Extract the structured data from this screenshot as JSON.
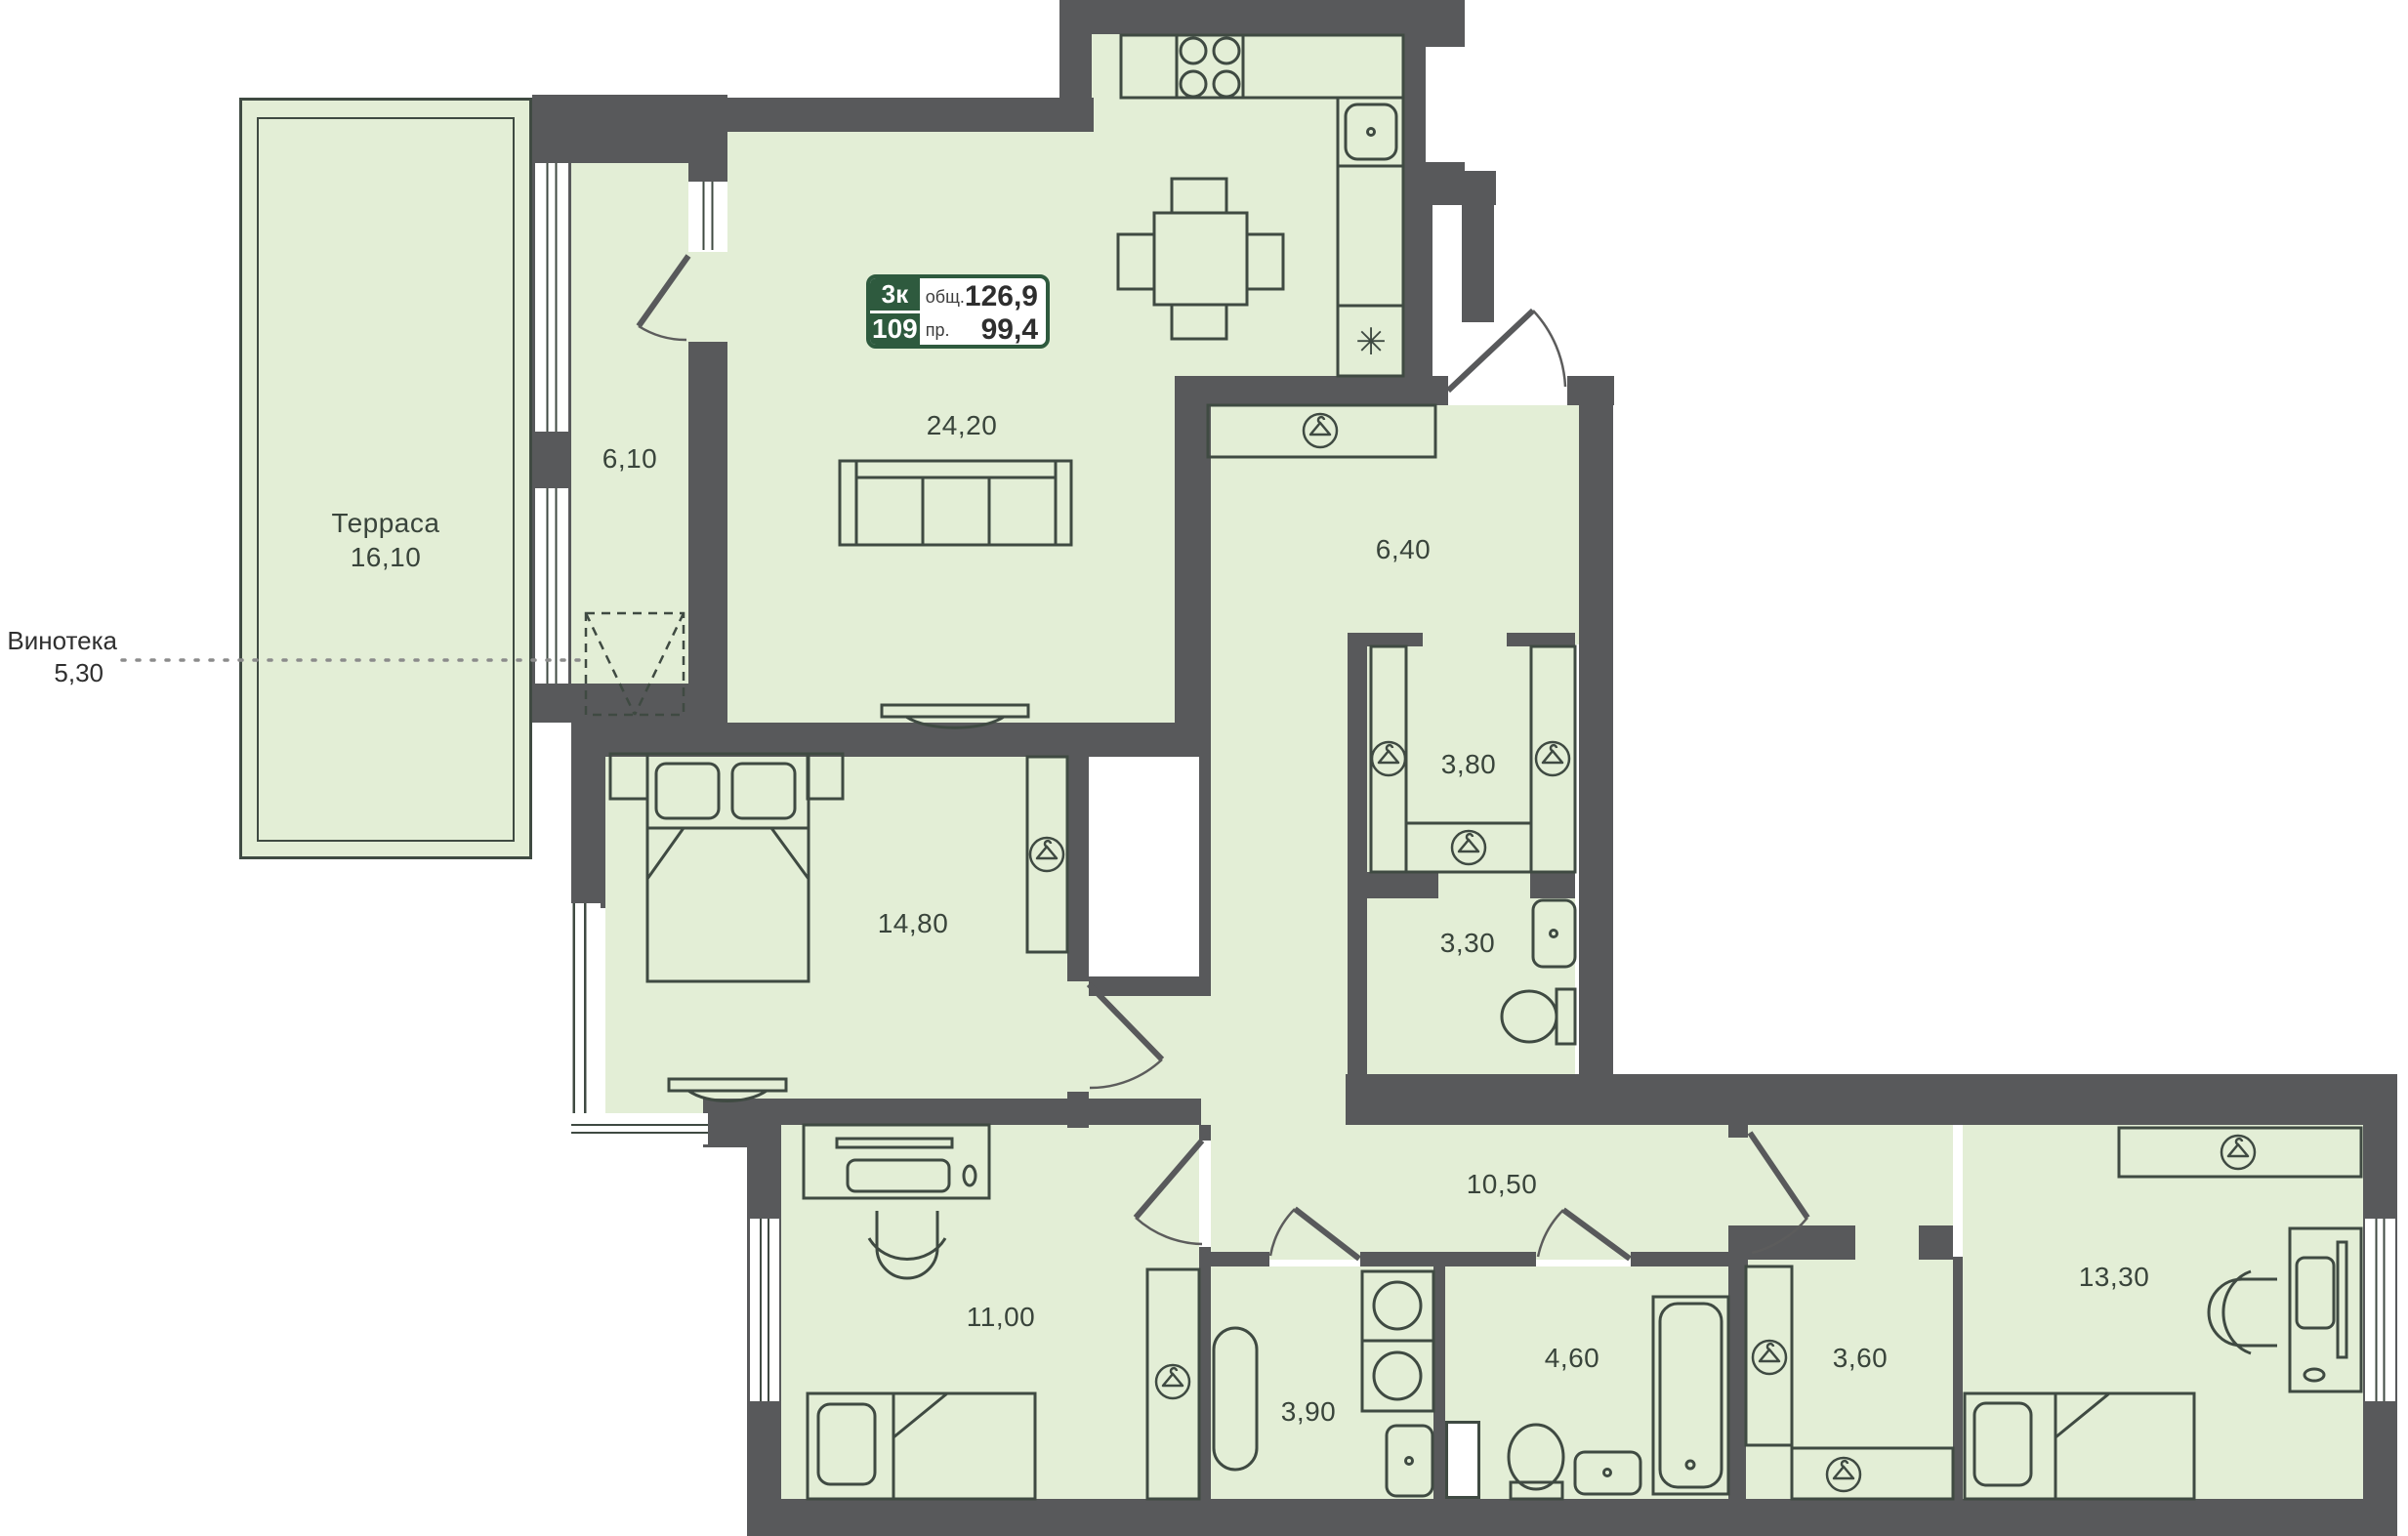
{
  "badge": {
    "rooms_count": "3к",
    "plan_number": "109",
    "total_label": "общ.",
    "total_area": "126,9",
    "living_label": "пр.",
    "living_area": "99,4"
  },
  "callout": {
    "name": "Винотека",
    "area": "5,30"
  },
  "rooms": {
    "terrace": {
      "name": "Терраса",
      "area": "16,10"
    },
    "loggia": {
      "area": "6,10"
    },
    "living": {
      "area": "24,20"
    },
    "hallway": {
      "area": "6,40"
    },
    "wardrobe": {
      "area": "3,80"
    },
    "wc": {
      "area": "3,30"
    },
    "bedroom1": {
      "area": "14,80"
    },
    "corridor": {
      "area": "10,50"
    },
    "kids_room": {
      "area": "11,00"
    },
    "laundry": {
      "area": "3,90"
    },
    "bathroom": {
      "area": "4,60"
    },
    "closet": {
      "area": "3,60"
    },
    "bedroom2": {
      "area": "13,30"
    }
  },
  "icons": {
    "snowflake": "✳"
  },
  "colors": {
    "wall": "#58595b",
    "room_fill": "#e3eed6",
    "line": "#3f4a42",
    "badge_green": "#2e5a3e"
  }
}
